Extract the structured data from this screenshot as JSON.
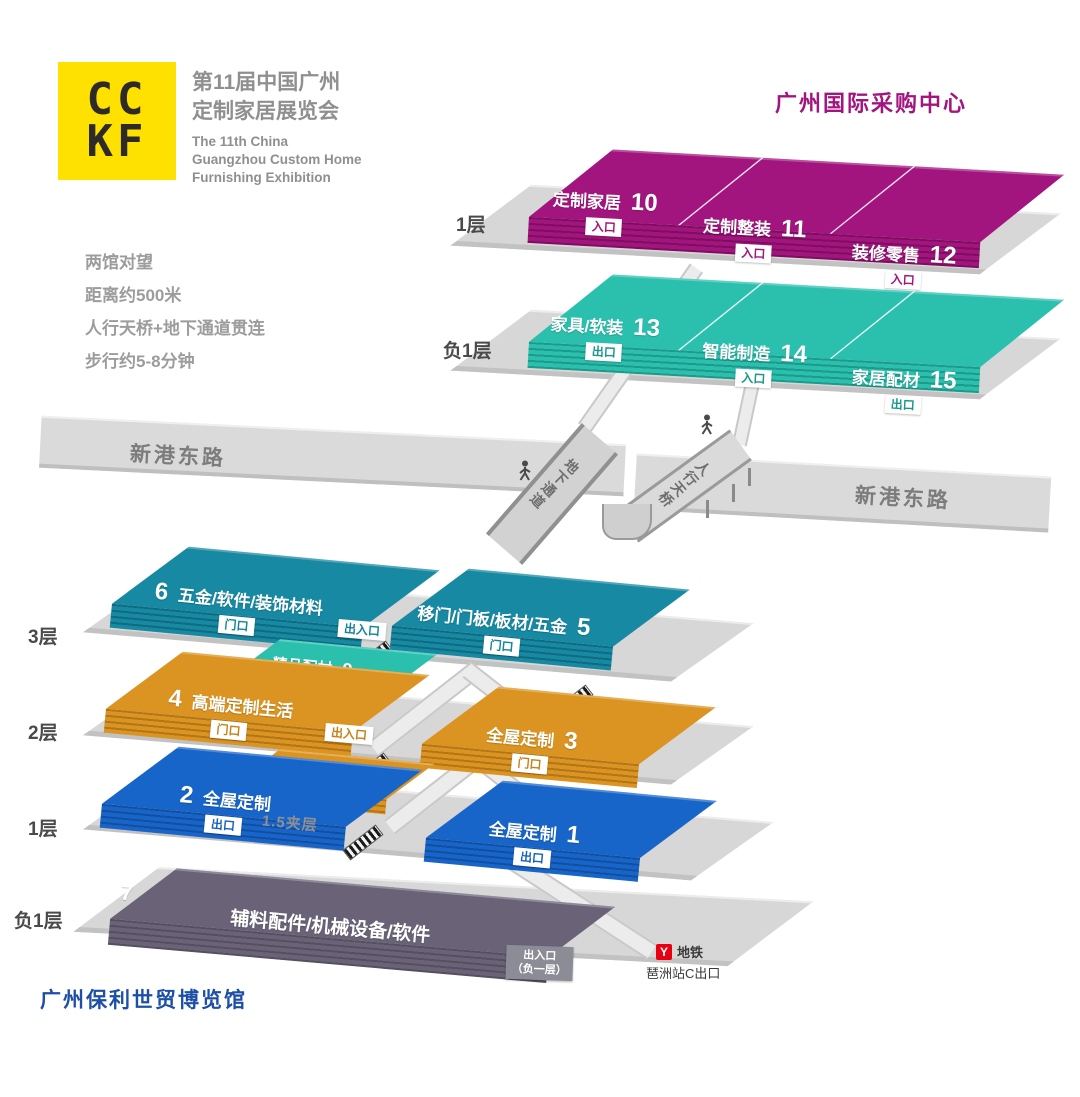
{
  "logo": {
    "line1": "CC",
    "line2": "KF"
  },
  "exhibition": {
    "title_cn_1": "第11届中国广州",
    "title_cn_2": "定制家居展览会",
    "title_en_1": "The 11th China",
    "title_en_2": "Guangzhou Custom Home",
    "title_en_3": "Furnishing Exhibition"
  },
  "info": {
    "l1": "两馆对望",
    "l2": "距离约500米",
    "l3": "人行天桥+地下通道贯连",
    "l4": "步行约5-8分钟"
  },
  "purchasing_center": {
    "title": "广州国际采购中心",
    "floor1_label": "1层",
    "floorB1_label": "负1层",
    "halls": {
      "h10": {
        "name": "定制家居",
        "num": "10",
        "badge": "入口"
      },
      "h11": {
        "name": "定制整装",
        "num": "11",
        "badge": "入口"
      },
      "h12": {
        "name": "装修零售",
        "num": "12",
        "badge": "入口"
      },
      "h13": {
        "name": "家具/软装",
        "num": "13",
        "badge": "出口"
      },
      "h14": {
        "name": "智能制造",
        "num": "14",
        "badge": "入口"
      },
      "h15": {
        "name": "家居配材",
        "num": "15",
        "badge": "出口"
      }
    }
  },
  "road": {
    "left": "新港东路",
    "right": "新港东路"
  },
  "crossing": {
    "underpass": "地下通道",
    "footbridge": "人行天桥"
  },
  "expo": {
    "title": "广州保利世贸博览馆",
    "floor3_label": "3层",
    "floor2_label": "2层",
    "floor1_label": "1层",
    "floorB1_label": "负1层",
    "halls": {
      "h6": {
        "num": "6",
        "name": "五金/软件/装饰材料",
        "badge": "门口"
      },
      "h5": {
        "name": "移门/门板/板材/五金",
        "num": "5",
        "badge": "门口"
      },
      "h9": {
        "name": "精品配材",
        "num": "9"
      },
      "h4": {
        "num": "4",
        "name": "高端定制生活",
        "badge": "门口"
      },
      "h3": {
        "name": "全屋定制",
        "num": "3",
        "badge": "门口"
      },
      "h8": {
        "name": "精品配材",
        "num": "8"
      },
      "h2": {
        "num": "2",
        "name": "全屋定制",
        "badge": "出口"
      },
      "h1": {
        "name": "全屋定制",
        "num": "1",
        "badge": "出口"
      },
      "h7": {
        "num": "7",
        "name": "辅料配件/机械设备/软件"
      }
    },
    "mezzanine": "1.5夹层",
    "access_badge_3f": "出入口",
    "access_badge_2f": "出入口",
    "b1_exit_line1": "出入口",
    "b1_exit_line2": "（负一层）",
    "metro": {
      "logo": "Y",
      "label": "地铁",
      "exit": "琶洲站C出口"
    }
  },
  "colors": {
    "magenta": "#A2157E",
    "teal": "#2BC0AE",
    "tealblue": "#1789A2",
    "orange": "#DB9421",
    "blue": "#1865C9",
    "purple": "#6A6378",
    "logo_yellow": "#FFE100",
    "title_blue": "#1D4FA6",
    "metro_red": "#E60012"
  }
}
